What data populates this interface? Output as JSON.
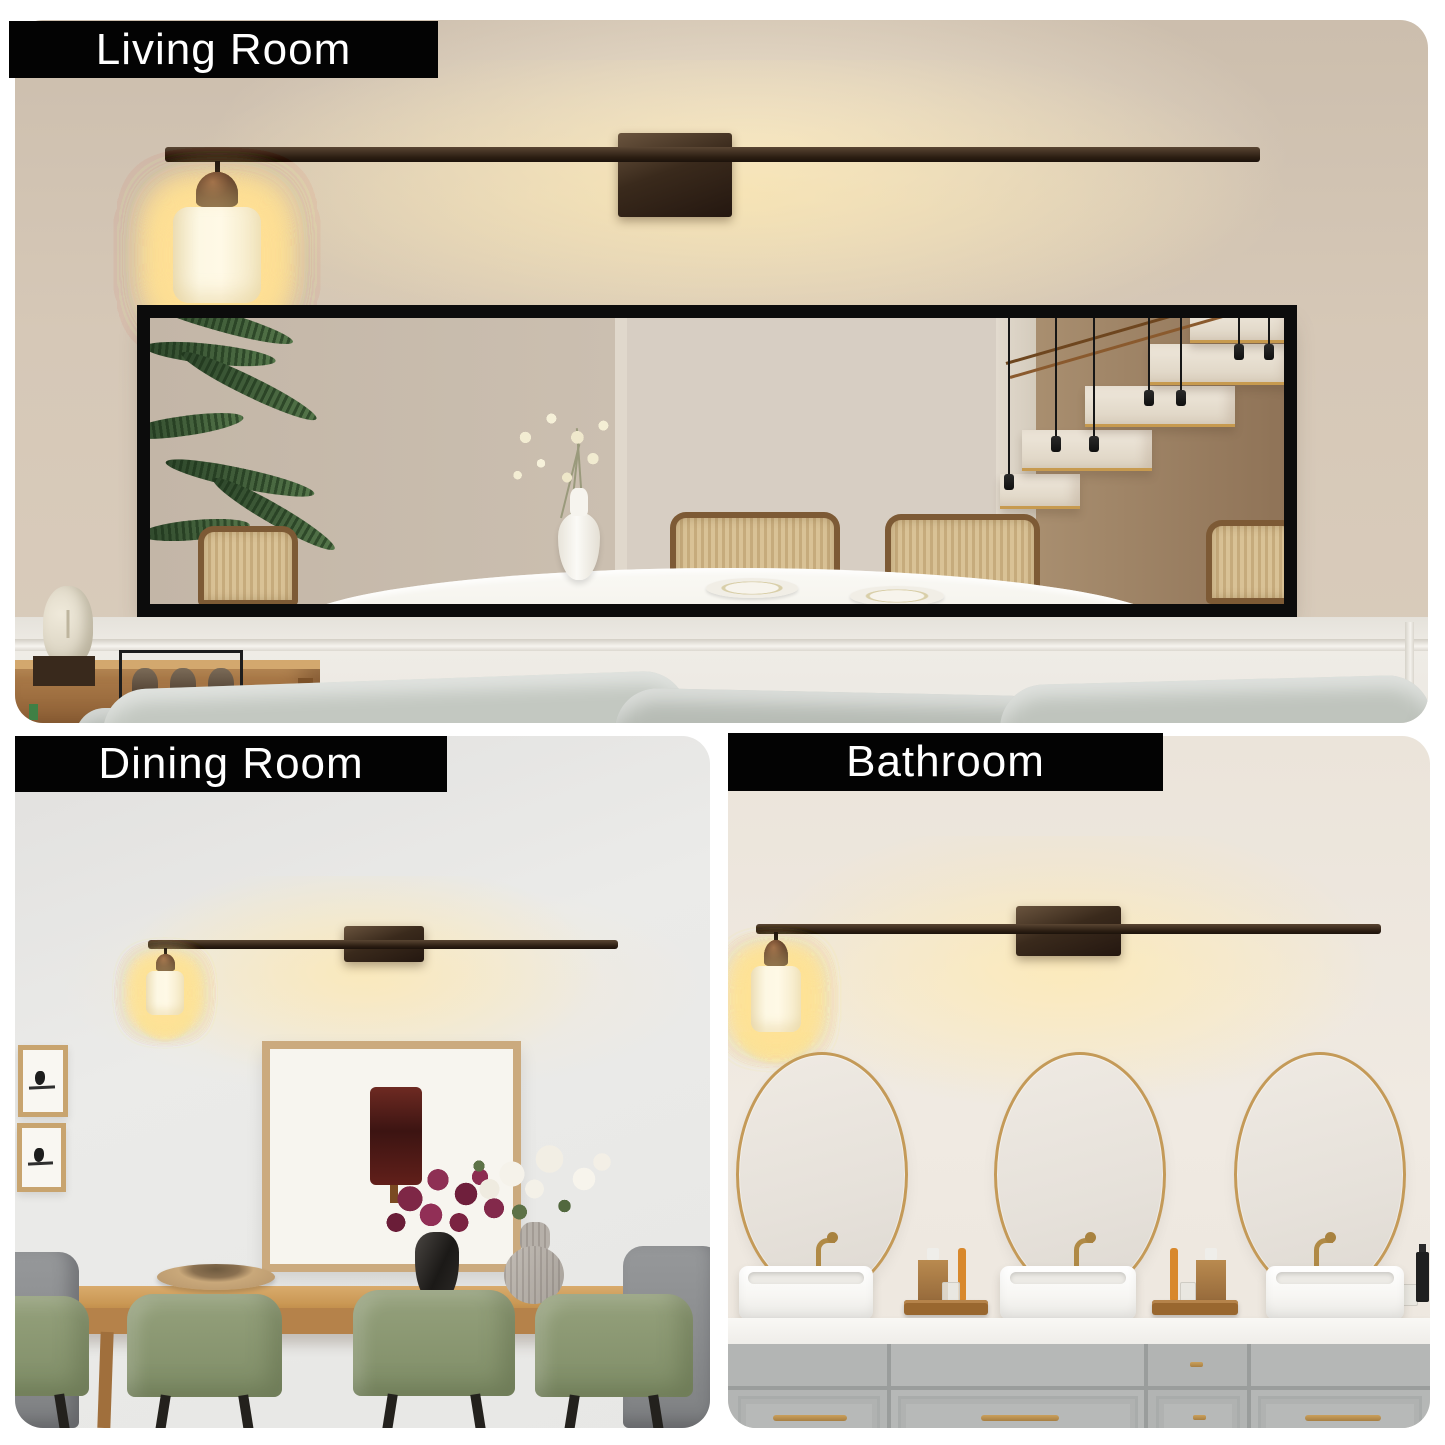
{
  "collage": {
    "background": "#ffffff",
    "label_bg": "#030303",
    "label_text_color": "#ffffff"
  },
  "panels": {
    "living": {
      "label": "Living Room",
      "fixture": {
        "lights": 10,
        "finish": "#3a2c1e",
        "shade": "#fbf3d8",
        "glow": "#ffe7a8"
      },
      "wall": "#d3c5b4",
      "mirror_frame": "#0c0c0c"
    },
    "dining": {
      "label": "Dining Room",
      "fixture": {
        "lights": 10,
        "finish": "#3a2c1e",
        "shade": "#fbf3d8"
      },
      "wall": "#e9e9e7",
      "table_wood": "#c6934f",
      "chair_green": "#8d9a74",
      "flower_magenta": "#7e2746",
      "flower_white": "#f5f2ea"
    },
    "bathroom": {
      "label": "Bathroom",
      "fixture": {
        "lights": 10,
        "finish": "#3a2c1e",
        "shade": "#fbf3d8"
      },
      "wall": "#efe9e1",
      "mirror_rim": "#c49a58",
      "vanity": "#b4b6b5",
      "counter": "#f6f5f2",
      "hardware_gold": "#b08a46"
    }
  }
}
